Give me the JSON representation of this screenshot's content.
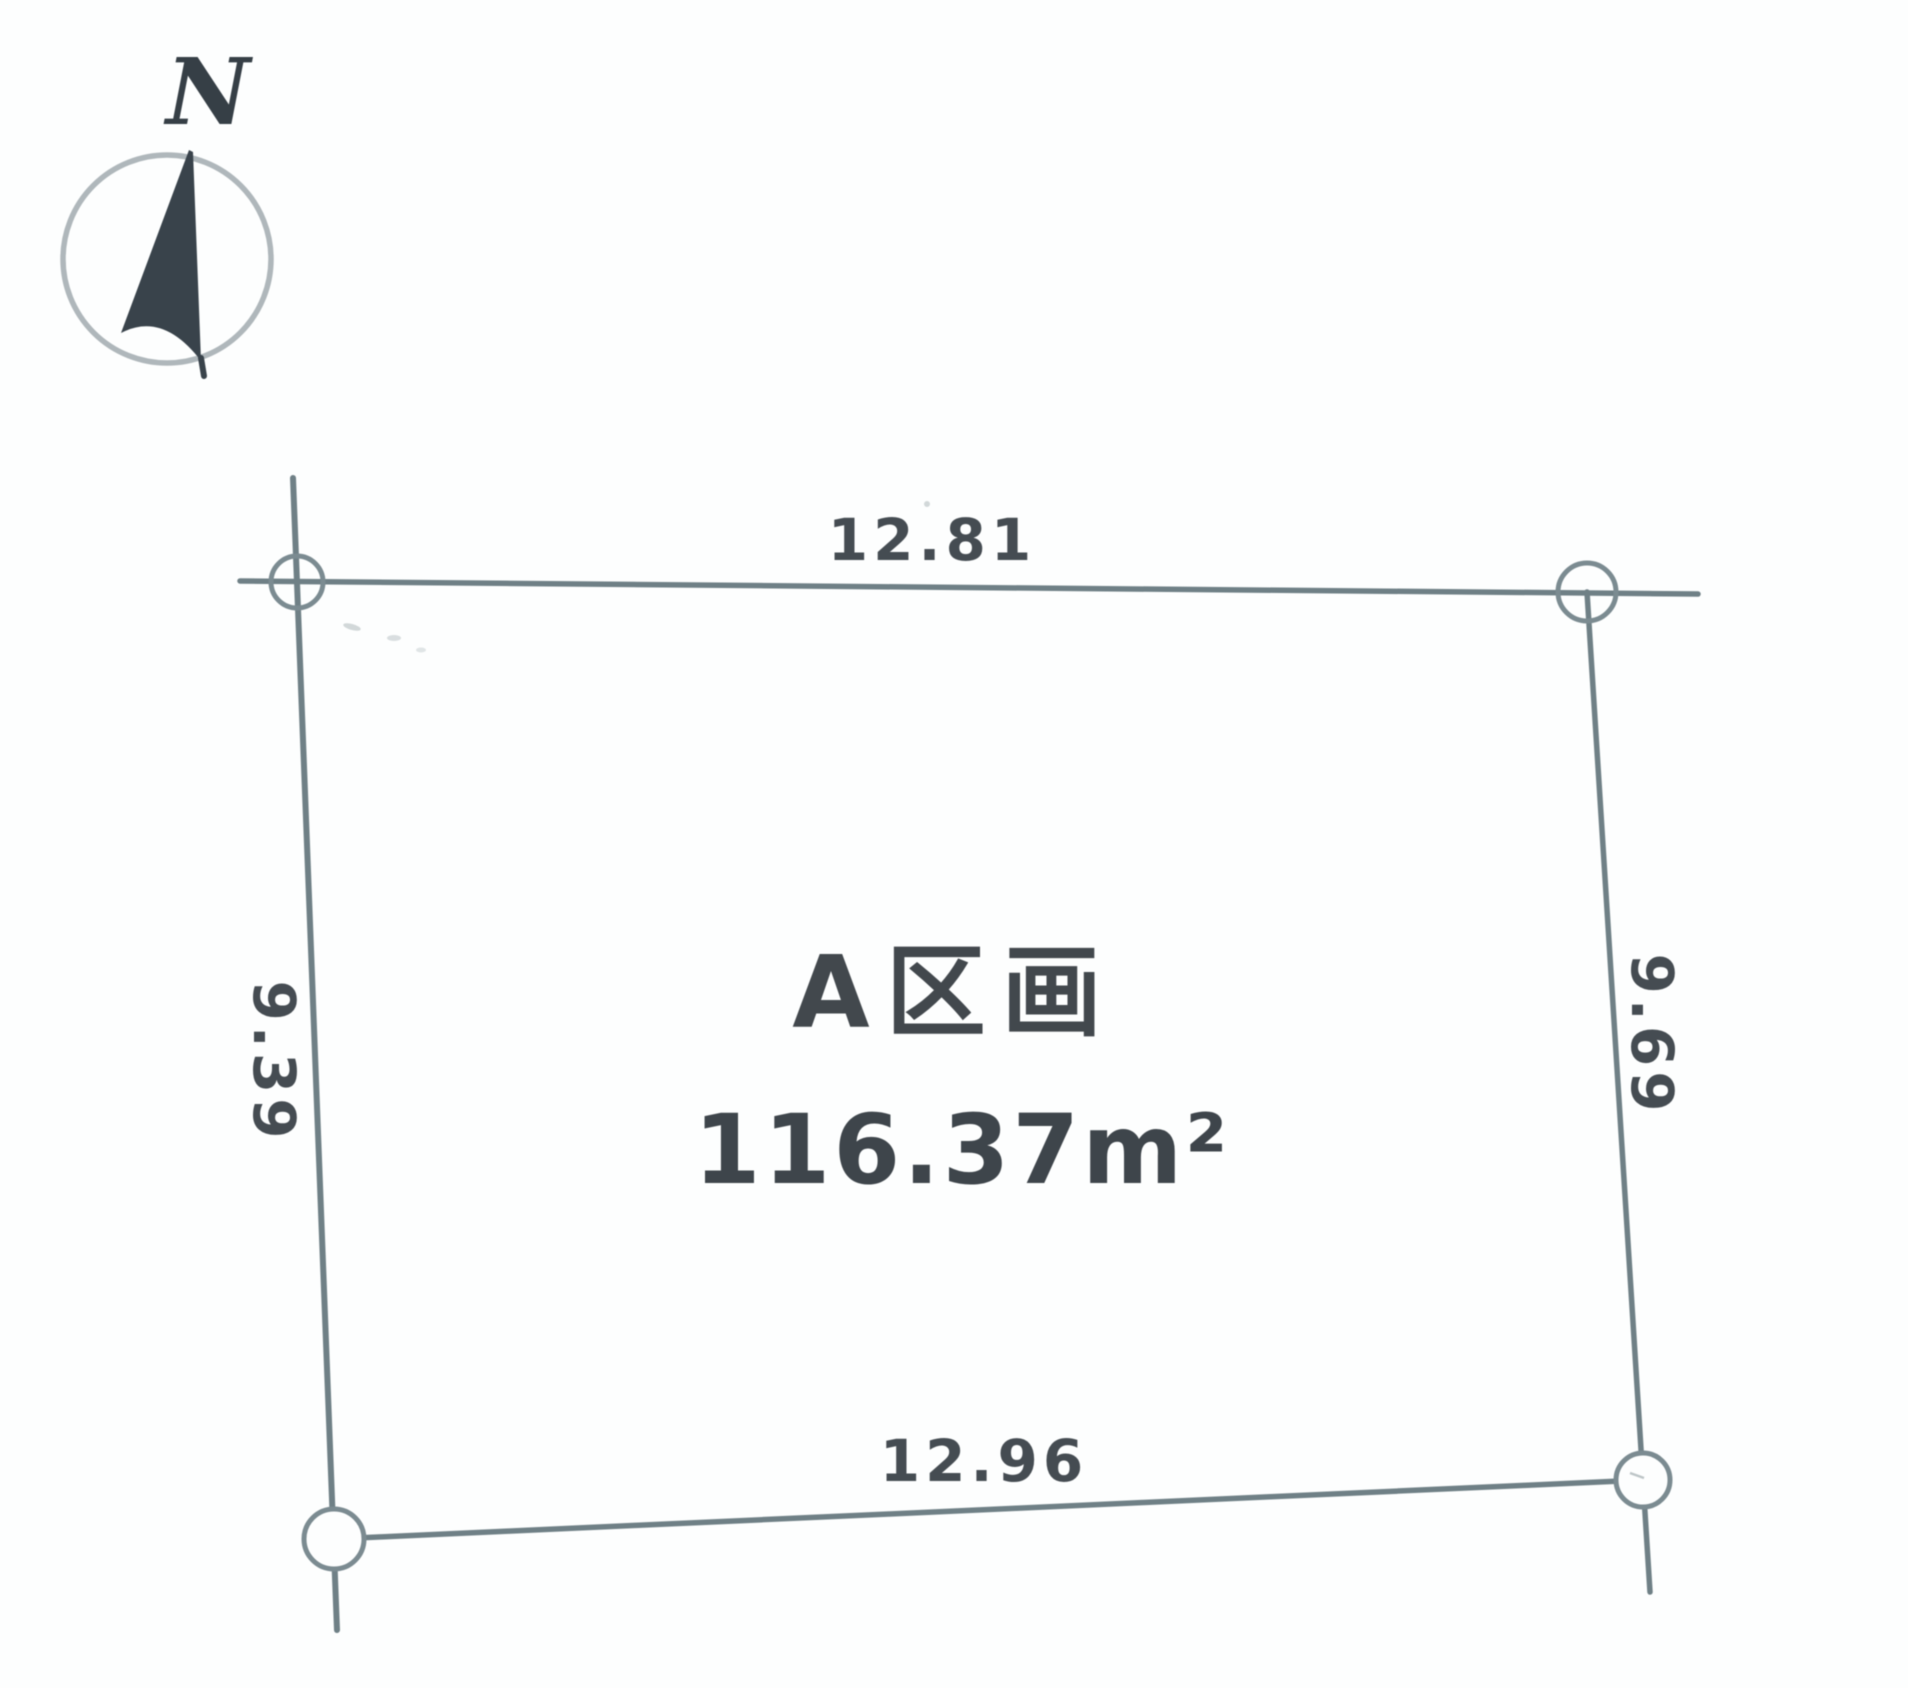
{
  "compass": {
    "north_label": "N"
  },
  "plot": {
    "name": "A区画",
    "area_value": "116.37",
    "area_unit": "m²",
    "dimensions": {
      "top": "12.81",
      "bottom": "12.96",
      "left": "9.39",
      "right": "9.69"
    }
  },
  "colors": {
    "line": "#6f8086",
    "marker_ring": "#7b8b91",
    "text": "#3e454b",
    "compass_ring": "#afb7bb",
    "compass_needle": "#39434b"
  }
}
